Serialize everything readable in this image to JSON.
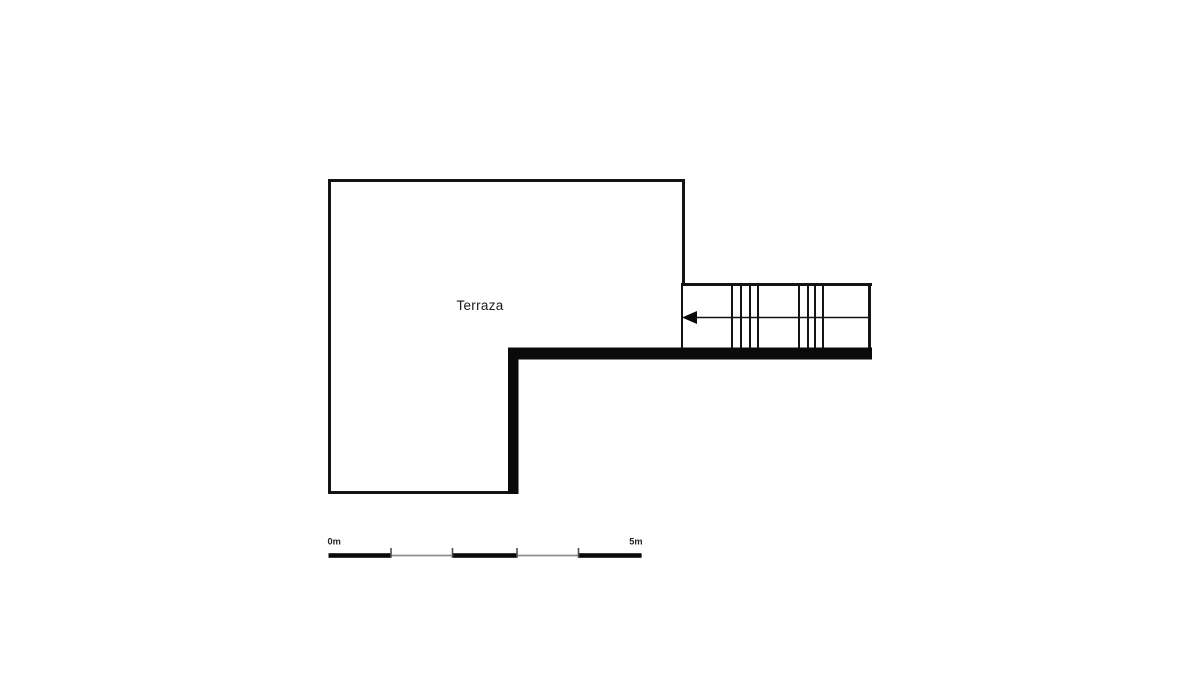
{
  "plan": {
    "room_label": "Terraza",
    "scale_bar": {
      "start_label": "0m",
      "end_label": "5m"
    },
    "colors": {
      "background": "#ffffff",
      "line": "#141414",
      "wall_fill": "#0a0a0a",
      "scale_line_gray": "#8f8f8f",
      "scale_tick_gray": "#4d4d4d"
    }
  }
}
